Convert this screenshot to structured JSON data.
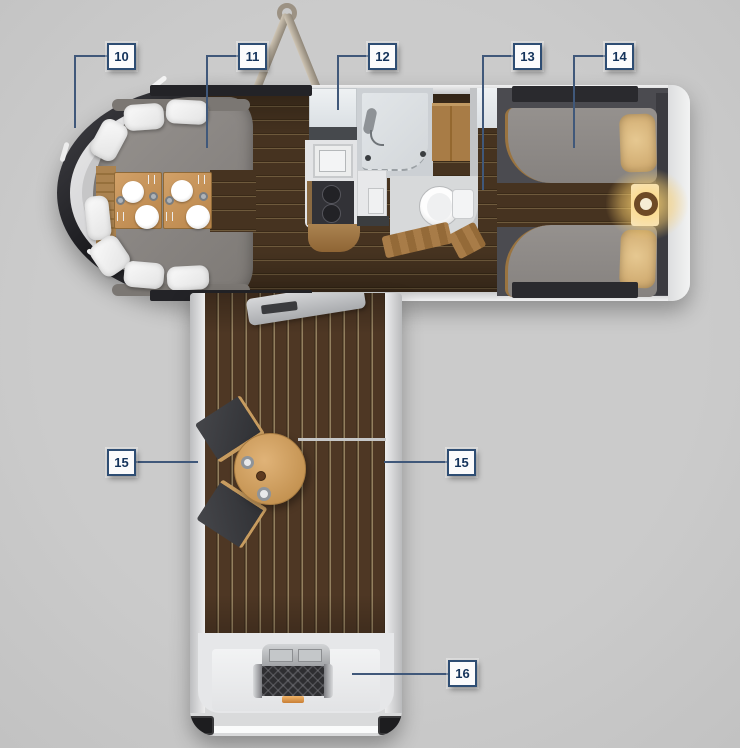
{
  "callouts": [
    {
      "number": "10"
    },
    {
      "number": "11"
    },
    {
      "number": "12"
    },
    {
      "number": "13"
    },
    {
      "number": "14"
    },
    {
      "number": "15"
    },
    {
      "number": "15"
    },
    {
      "number": "16"
    }
  ],
  "colors": {
    "background": "#c8c8c8",
    "callout_border": "#2e4d73",
    "callout_text": "#14335b",
    "leader_line": "#40587a",
    "hull_dark": "#232327",
    "trim_silver": "#d6d6d7",
    "interior_wood": "#42301f",
    "deck_wood": "#4b3524",
    "sofa_gray": "#8b8784",
    "table_wood": "#c9965a",
    "bed_gray": "#908c89",
    "pillow_beige": "#dcbb83",
    "lamp_glow": "#f5c96a",
    "grill_dark": "#2e2e31",
    "handle_orange": "#e09a4a"
  }
}
